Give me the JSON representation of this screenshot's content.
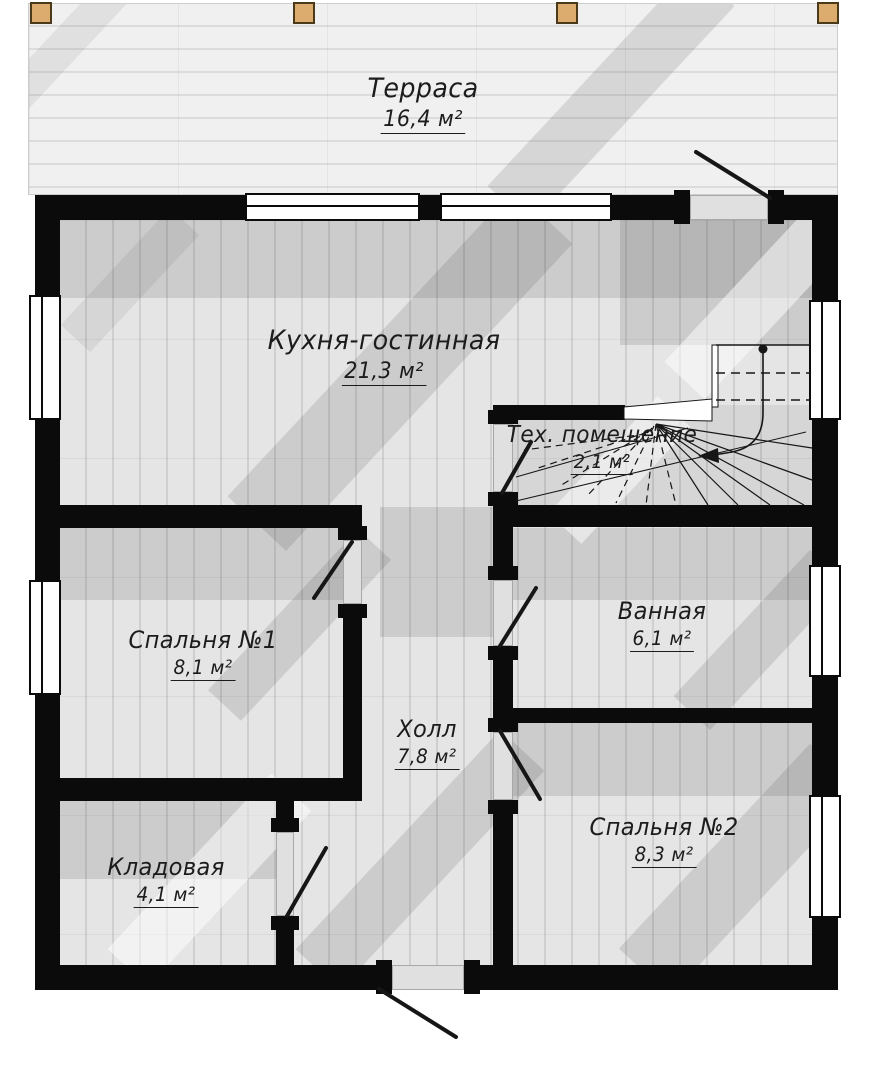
{
  "plan": {
    "rooms": [
      {
        "id": "terrace",
        "name": "Терраса",
        "area": "16,4 м²"
      },
      {
        "id": "kitchen",
        "name": "Кухня-гостинная",
        "area": "21,3 м²"
      },
      {
        "id": "tech",
        "name": "Тех. помещение",
        "area": "2,1 м²"
      },
      {
        "id": "bedroom1",
        "name": "Спальня №1",
        "area": "8,1 м²"
      },
      {
        "id": "bathroom",
        "name": "Ванная",
        "area": "6,1 м²"
      },
      {
        "id": "hall",
        "name": "Холл",
        "area": "7,8 м²"
      },
      {
        "id": "bedroom2",
        "name": "Спальня №2",
        "area": "8,3 м²"
      },
      {
        "id": "storage",
        "name": "Кладовая",
        "area": "4,1 м²"
      }
    ],
    "colors": {
      "wall": "#0b0b0b",
      "floor": "#e5e5e5",
      "plank_line": "#cfcfcf",
      "terrace_floor": "#f0f0f0",
      "terrace_line": "#dcdcdc",
      "post": "#dcab6e",
      "post_border": "#4a3a1a",
      "label": "#1c1c1c",
      "window": "#ffffff"
    }
  }
}
